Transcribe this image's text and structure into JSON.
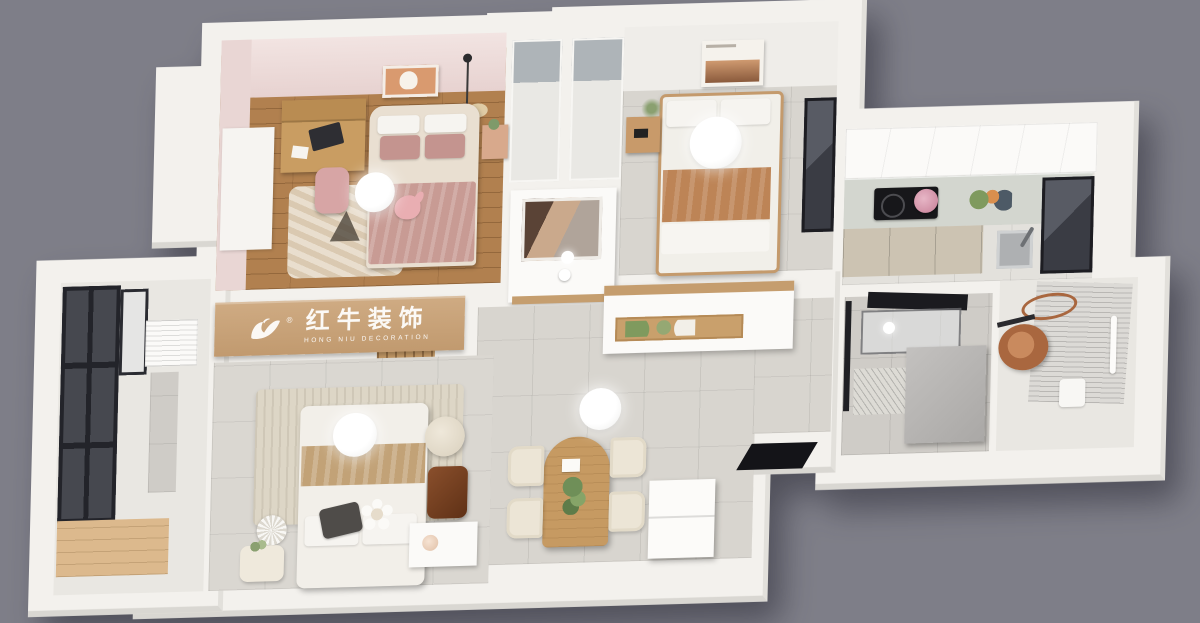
{
  "scene": {
    "kind": "3d-dollhouse-floorplan-render",
    "view": "top-down axonometric interior rendering of a small apartment"
  },
  "watermark": {
    "cn": "红牛装饰",
    "en": "HONG NIU DECORATION",
    "reg": "®",
    "icon": "bull-logo-icon"
  },
  "colors": {
    "background": "#7e7e88",
    "wall_white": "#f3f1ed",
    "pink_wall": "#eadbd8",
    "wood_floor": "#b1804f",
    "tile_floor": "#d8d5cf",
    "balcony_deck": "#dcb98d",
    "brand_beam_wood": "#c7a47d",
    "terracotta_throw": "#bd8456",
    "mauve_bedding": "#c4948f",
    "copper_basin": "#a9673f",
    "dark_window": "#1d1d22"
  },
  "rooms": [
    {
      "id": "kids-bedroom",
      "furniture": [
        "desk-with-hutch",
        "desk-chair",
        "single-bed",
        "mauve-bedding",
        "rug",
        "ceiling-lamp",
        "wall-art",
        "pendant-light",
        "nightstand",
        "plush-toy",
        "wall-panel"
      ]
    },
    {
      "id": "wardrobe-block",
      "furniture": [
        "closet-unit-left",
        "closet-unit-right"
      ]
    },
    {
      "id": "entry",
      "furniture": [
        "mirror-cabinet",
        "ceiling-spotlight"
      ]
    },
    {
      "id": "second-bedroom",
      "furniture": [
        "single-bed",
        "terracotta-throw",
        "nightstand",
        "plant",
        "wall-art",
        "ceiling-lamp",
        "window"
      ]
    },
    {
      "id": "kitchen",
      "furniture": [
        "upper-cabinets",
        "countertop",
        "cooktop",
        "kettle",
        "groceries",
        "base-cabinets",
        "sink",
        "window"
      ]
    },
    {
      "id": "dining-hall",
      "furniture": [
        "sideboard-with-wood-niche",
        "dining-table",
        "dining-chairs",
        "table-plant",
        "ceiling-lamp",
        "entry-spotlight",
        "fridge",
        "dark-doorway"
      ]
    },
    {
      "id": "bathroom",
      "furniture": [
        "glass-shower-screen",
        "dome-lights",
        "drain-mat",
        "partition-block"
      ]
    },
    {
      "id": "laundry-room",
      "furniture": [
        "copper-basin",
        "copper-ring",
        "drying-rack",
        "towel-bar",
        "floor-mat"
      ]
    },
    {
      "id": "master-bedroom",
      "furniture": [
        "double-bed",
        "striped-rug",
        "ceiling-lamp",
        "pouf",
        "leather-chair",
        "vanity-desk",
        "flower-pillow",
        "gray-pillow",
        "floor-lamp",
        "side-table",
        "wood-slat-ceiling"
      ]
    },
    {
      "id": "balcony",
      "furniture": [
        "window-wall",
        "ac-unit",
        "tile-column",
        "wood-deck"
      ]
    }
  ]
}
